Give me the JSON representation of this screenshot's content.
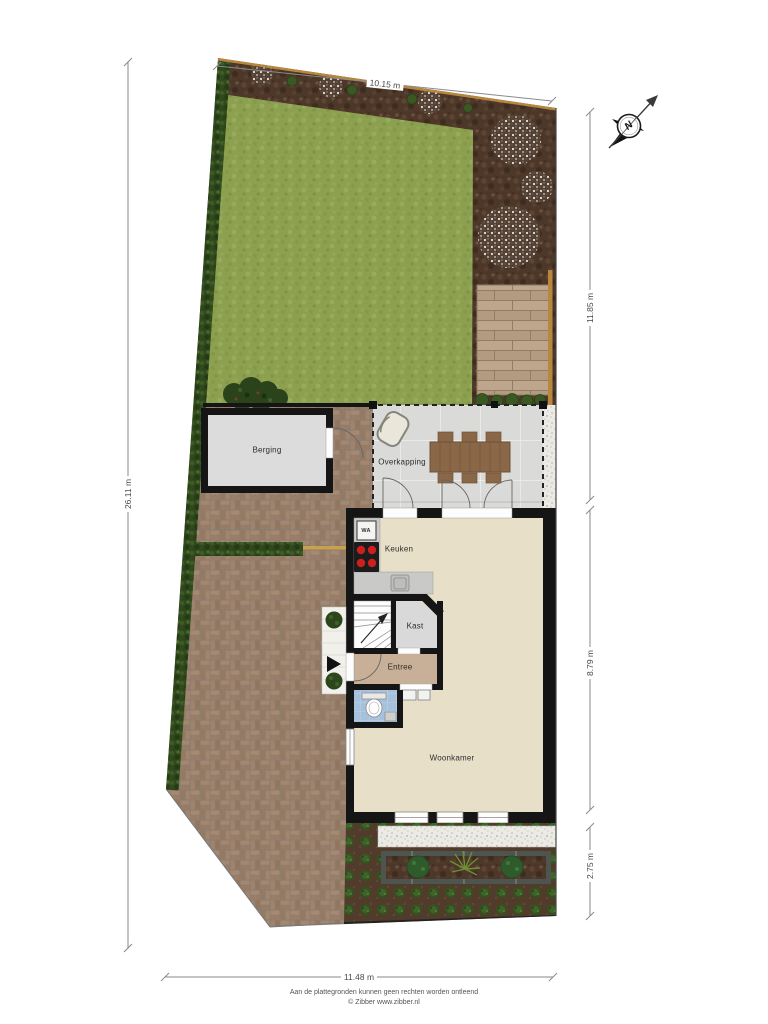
{
  "document": {
    "type": "garden-and-ground-floor-plan",
    "footer": {
      "line1": "Aan de plattegronden kunnen geen rechten worden ontleend",
      "line2": "© Zibber www.zibber.nl"
    }
  },
  "compass": {
    "north_label": "N"
  },
  "dimensions": {
    "top": "10.15 m",
    "left": "26.11 m",
    "right_top": "11.85 m",
    "right_middle": "8.79 m",
    "right_bottom": "2.75 m",
    "bottom": "11.48 m"
  },
  "rooms": {
    "berging": "Berging",
    "overkapping": "Overkapping",
    "keuken": "Keuken",
    "kast": "Kast",
    "entree": "Entree",
    "woonkamer": "Woonkamer"
  },
  "appliances": {
    "washing_machine": "WA"
  },
  "colors": {
    "lawn": "#8da050",
    "soil": "#4c3728",
    "paving": "#9c7e67",
    "hedge": "#31491d",
    "wall": "#151515",
    "room_floor": "#e7dfc8",
    "storage_floor": "#dcdcdc",
    "entree_floor": "#c7b097",
    "toilet_floor": "#a6c1dc",
    "deck": "#bda68c",
    "fence": "#b8873f",
    "gravel": "#eceae5",
    "table_wood": "#8a6747",
    "cooktop_burner": "#cc1f1f"
  }
}
